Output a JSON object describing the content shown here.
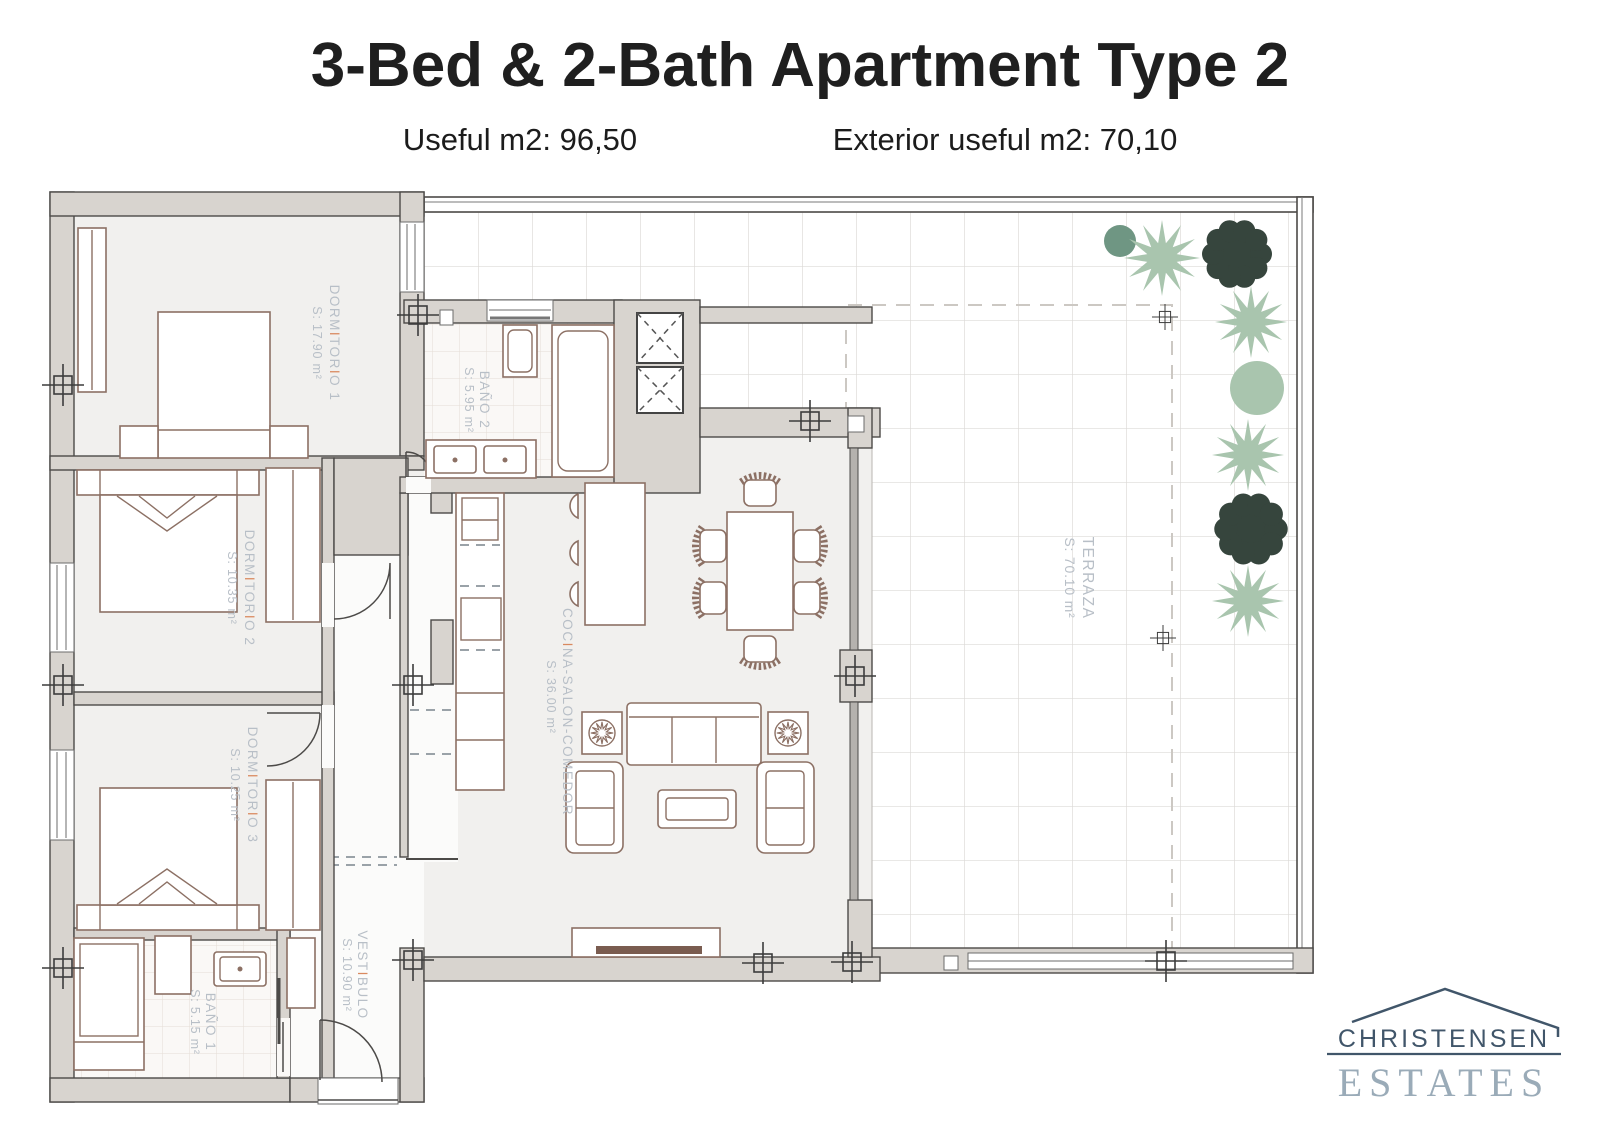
{
  "header": {
    "title": "3-Bed & 2-Bath Apartment Type 2",
    "useful": "Useful m2: 96,50",
    "exterior": "Exterior useful m2: 70,10"
  },
  "plan": {
    "rooms": [
      {
        "id": "dormitorio-1",
        "name": "DORMITORIO 1",
        "area": "S: 17.90 m²"
      },
      {
        "id": "dormitorio-2",
        "name": "DORMITORIO 2",
        "area": "S: 10.35 m²"
      },
      {
        "id": "dormitorio-3",
        "name": "DORMITORIO 3",
        "area": "S: 10.25 m²"
      },
      {
        "id": "bano-1",
        "name": "BAÑO 1",
        "area": "S: 5.15 m²"
      },
      {
        "id": "bano-2",
        "name": "BAÑO 2",
        "area": "S: 5.95 m²"
      },
      {
        "id": "cocina-salon-comedor",
        "name": "COCINA-SALON-COMEDOR",
        "area": "S: 36.00 m²"
      },
      {
        "id": "vestibulo",
        "name": "VESTIBULO",
        "area": "S: 10.90 m²"
      },
      {
        "id": "terraza",
        "name": "TERRAZA",
        "area": "S: 70.10 m²"
      }
    ]
  },
  "logo": {
    "line1": "CHRISTENSEN",
    "line2": "ESTATES"
  },
  "colors": {
    "label": "#b8bfc7",
    "label_accent": "#d9895f",
    "logo_dark": "#41566a",
    "logo_light": "#9aabb8",
    "wall": "#d8d4cf",
    "plant_light": "#a9c5ae",
    "plant_dark": "#36453d"
  }
}
